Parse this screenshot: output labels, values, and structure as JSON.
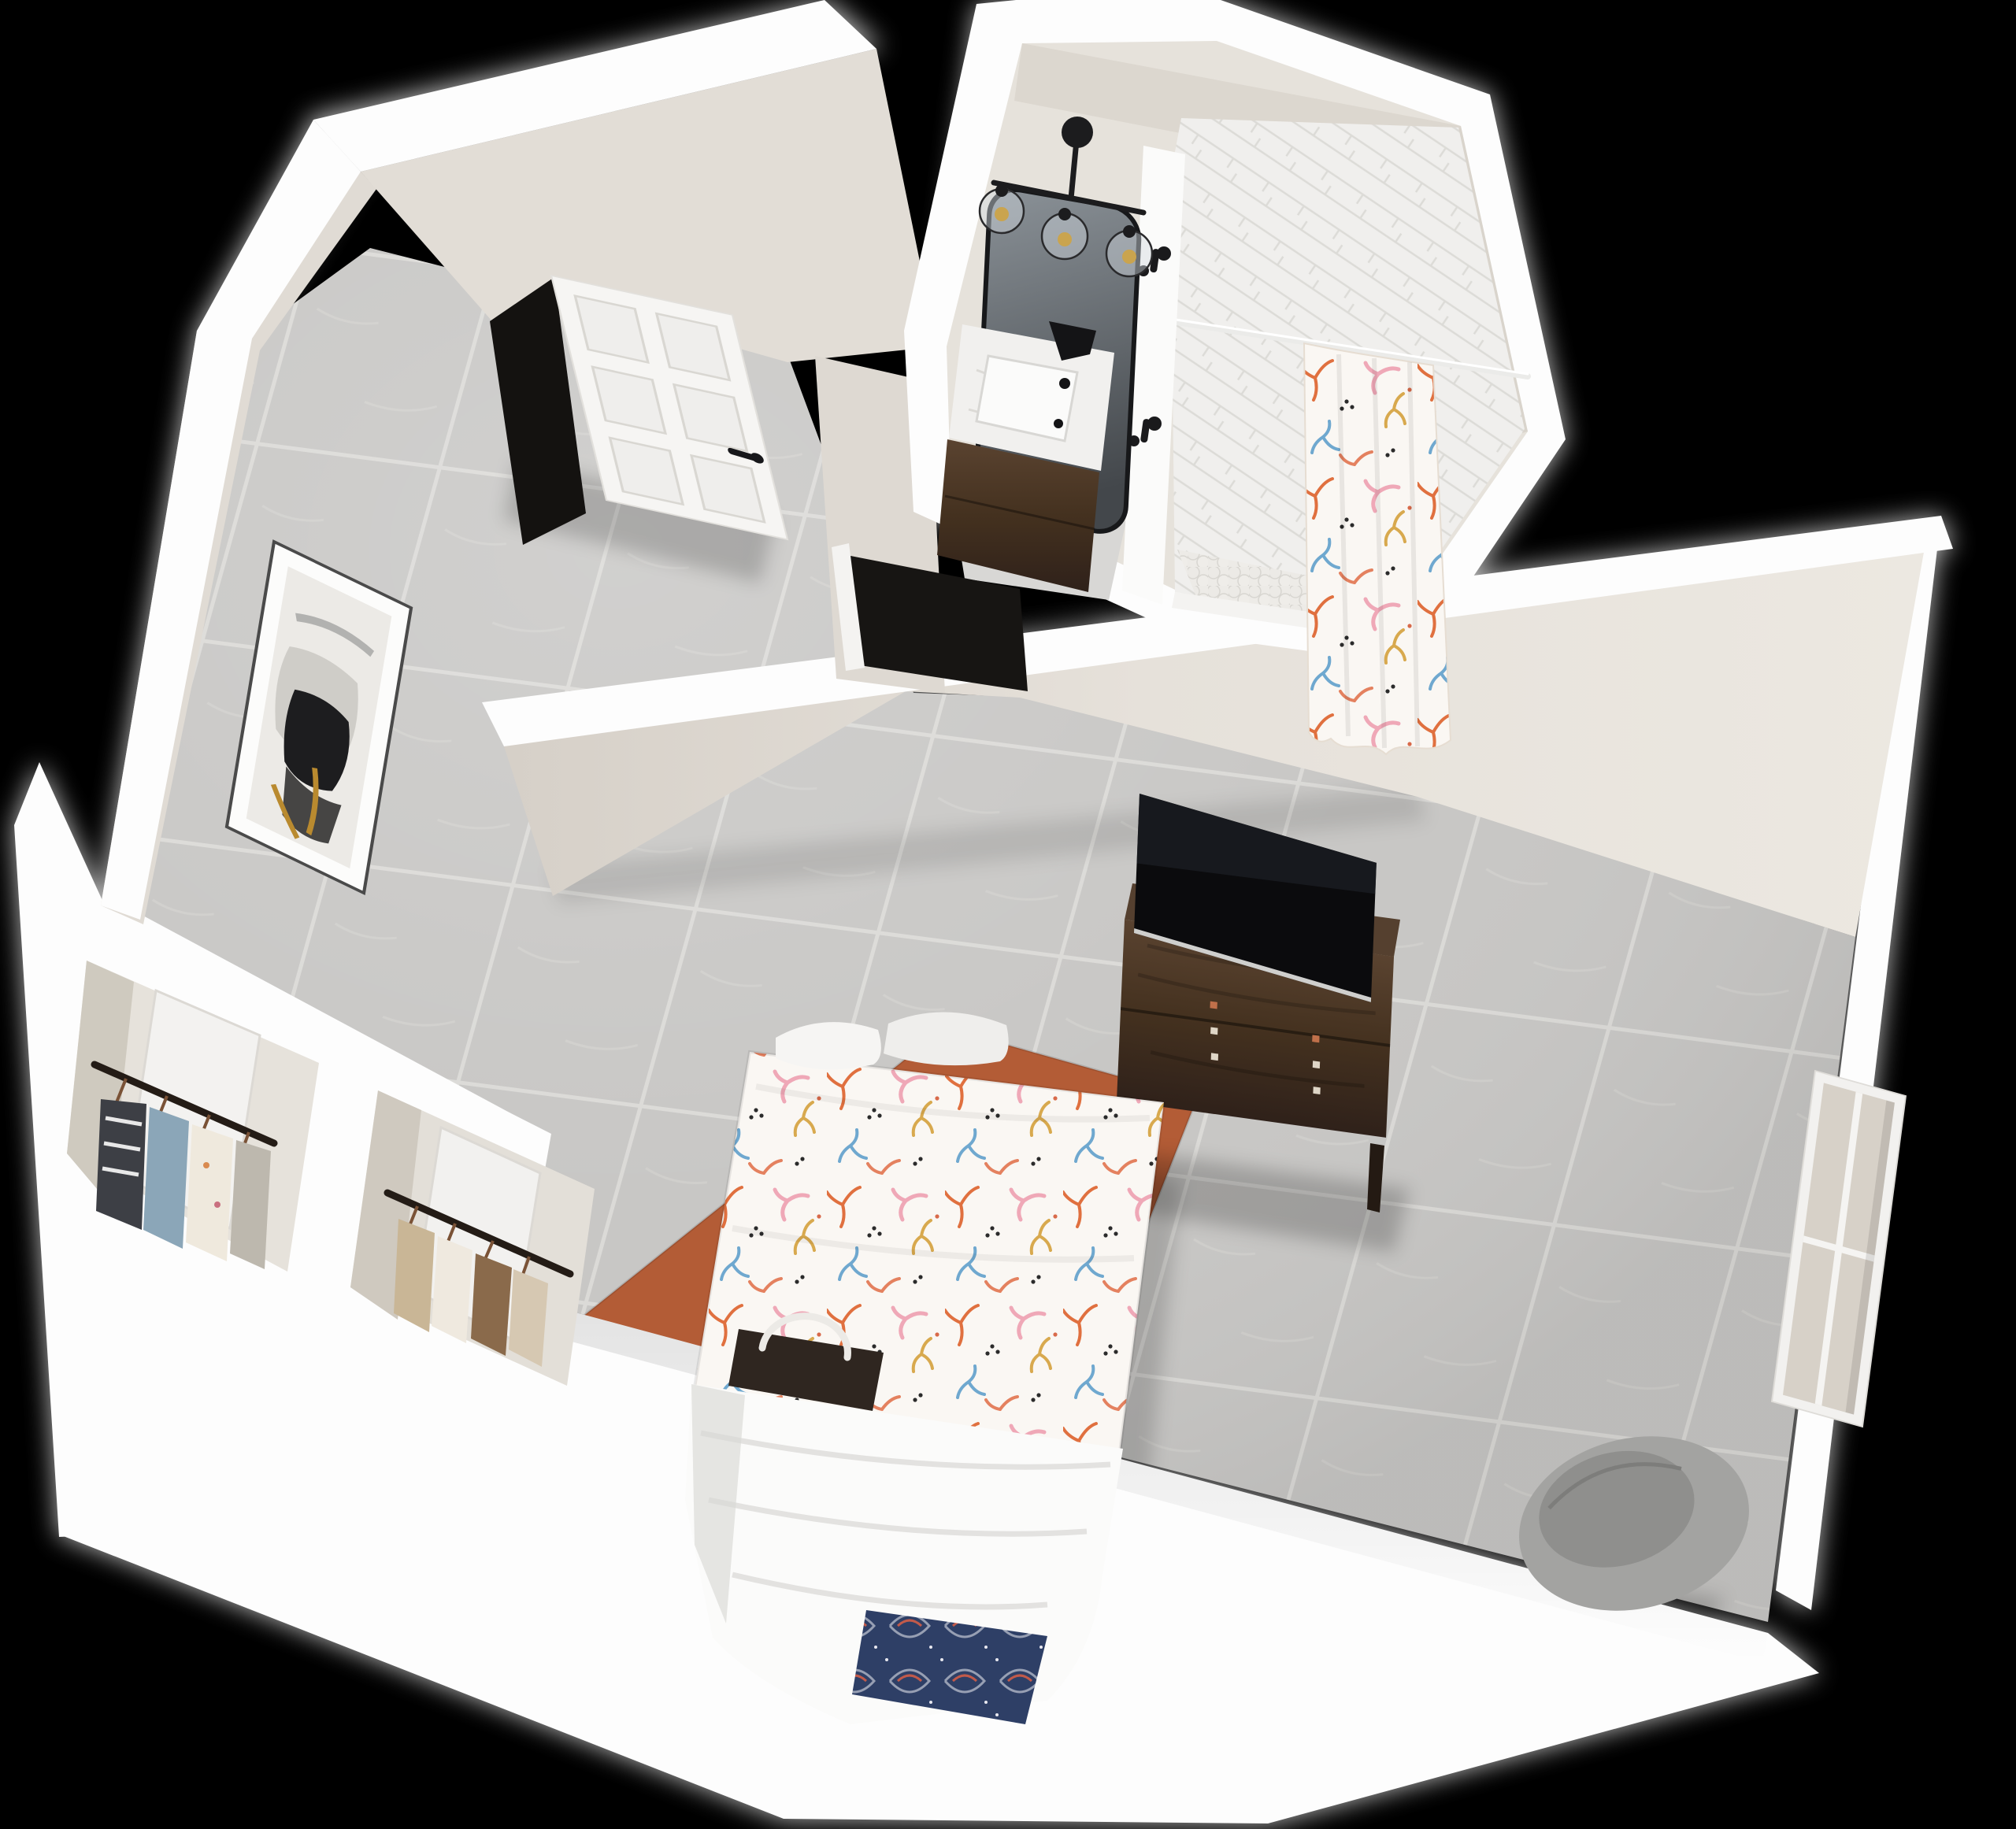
{
  "meta": {
    "title": "3D rendered studio apartment floor plan",
    "view": "aerial dollhouse perspective",
    "background": "#000000"
  },
  "accessibility": {
    "image_label": "3D rendered floor plan of a studio apartment with an entry door, bathroom with shower and vanity, two closets with hanging clothes, and a combined bedroom living area with bed, dresser, TV, rug, window and chair"
  },
  "rooms": [
    {
      "name": "bedroom-living-area"
    },
    {
      "name": "bathroom"
    },
    {
      "name": "entry-hall"
    },
    {
      "name": "closet-left"
    },
    {
      "name": "closet-right"
    }
  ],
  "furniture": [
    {
      "name": "queen-bed",
      "details": "coral print duvet, white pillows, folded white blanket, navy accent pillow"
    },
    {
      "name": "dresser",
      "details": "dark walnut, two drawers, metal pulls"
    },
    {
      "name": "flat-screen-tv",
      "details": "leaning on dresser against wall"
    },
    {
      "name": "area-rug",
      "details": "terracotta"
    },
    {
      "name": "bench-with-basket",
      "details": "foot of bed"
    },
    {
      "name": "accent-chair",
      "details": "gray upholstered, corner"
    },
    {
      "name": "framed-abstract-art",
      "details": "black, white and gold abstract on entry wall"
    }
  ],
  "bathroom_fixtures": [
    {
      "name": "vanity",
      "details": "dark wood cabinet, marble top, black faucet"
    },
    {
      "name": "arched-mirror",
      "details": "black frame"
    },
    {
      "name": "vanity-light",
      "details": "black 3-globe fixture"
    },
    {
      "name": "walk-in-shower",
      "details": "white herringbone tile, pebble floor"
    },
    {
      "name": "shower-curtain",
      "details": "coral reef print"
    },
    {
      "name": "robe-hooks",
      "details": "matte black, two"
    }
  ],
  "palette": {
    "background": "#000000",
    "wall_top": "#fdfdfd",
    "wall_face": "#e2ddd5",
    "wall_face_shadow": "#d6d0c8",
    "floor_tile": "#c8c7c5",
    "grout": "#dbdad7",
    "rug": "#b35c36",
    "wood_dark": "#4a3526",
    "tv_screen": "#0b0b0d",
    "curtain_base": "#faf7f3",
    "coral_orange": "#e0703f",
    "coral_pink": "#efa8b7",
    "coral_blue": "#6fa8cf",
    "coral_gold": "#d8a94e",
    "navy_pillow": "#2e3f66",
    "chair_gray": "#a3a3a1",
    "marble": "#f1f0ee",
    "mirror_glass": "#5c6368",
    "shower_tile": "#f0efed",
    "bath_floor": "#d8d7d5",
    "door_white": "#f6f5f3",
    "black_fixture": "#1a1a1c",
    "bed_white": "#fbfbfa"
  }
}
